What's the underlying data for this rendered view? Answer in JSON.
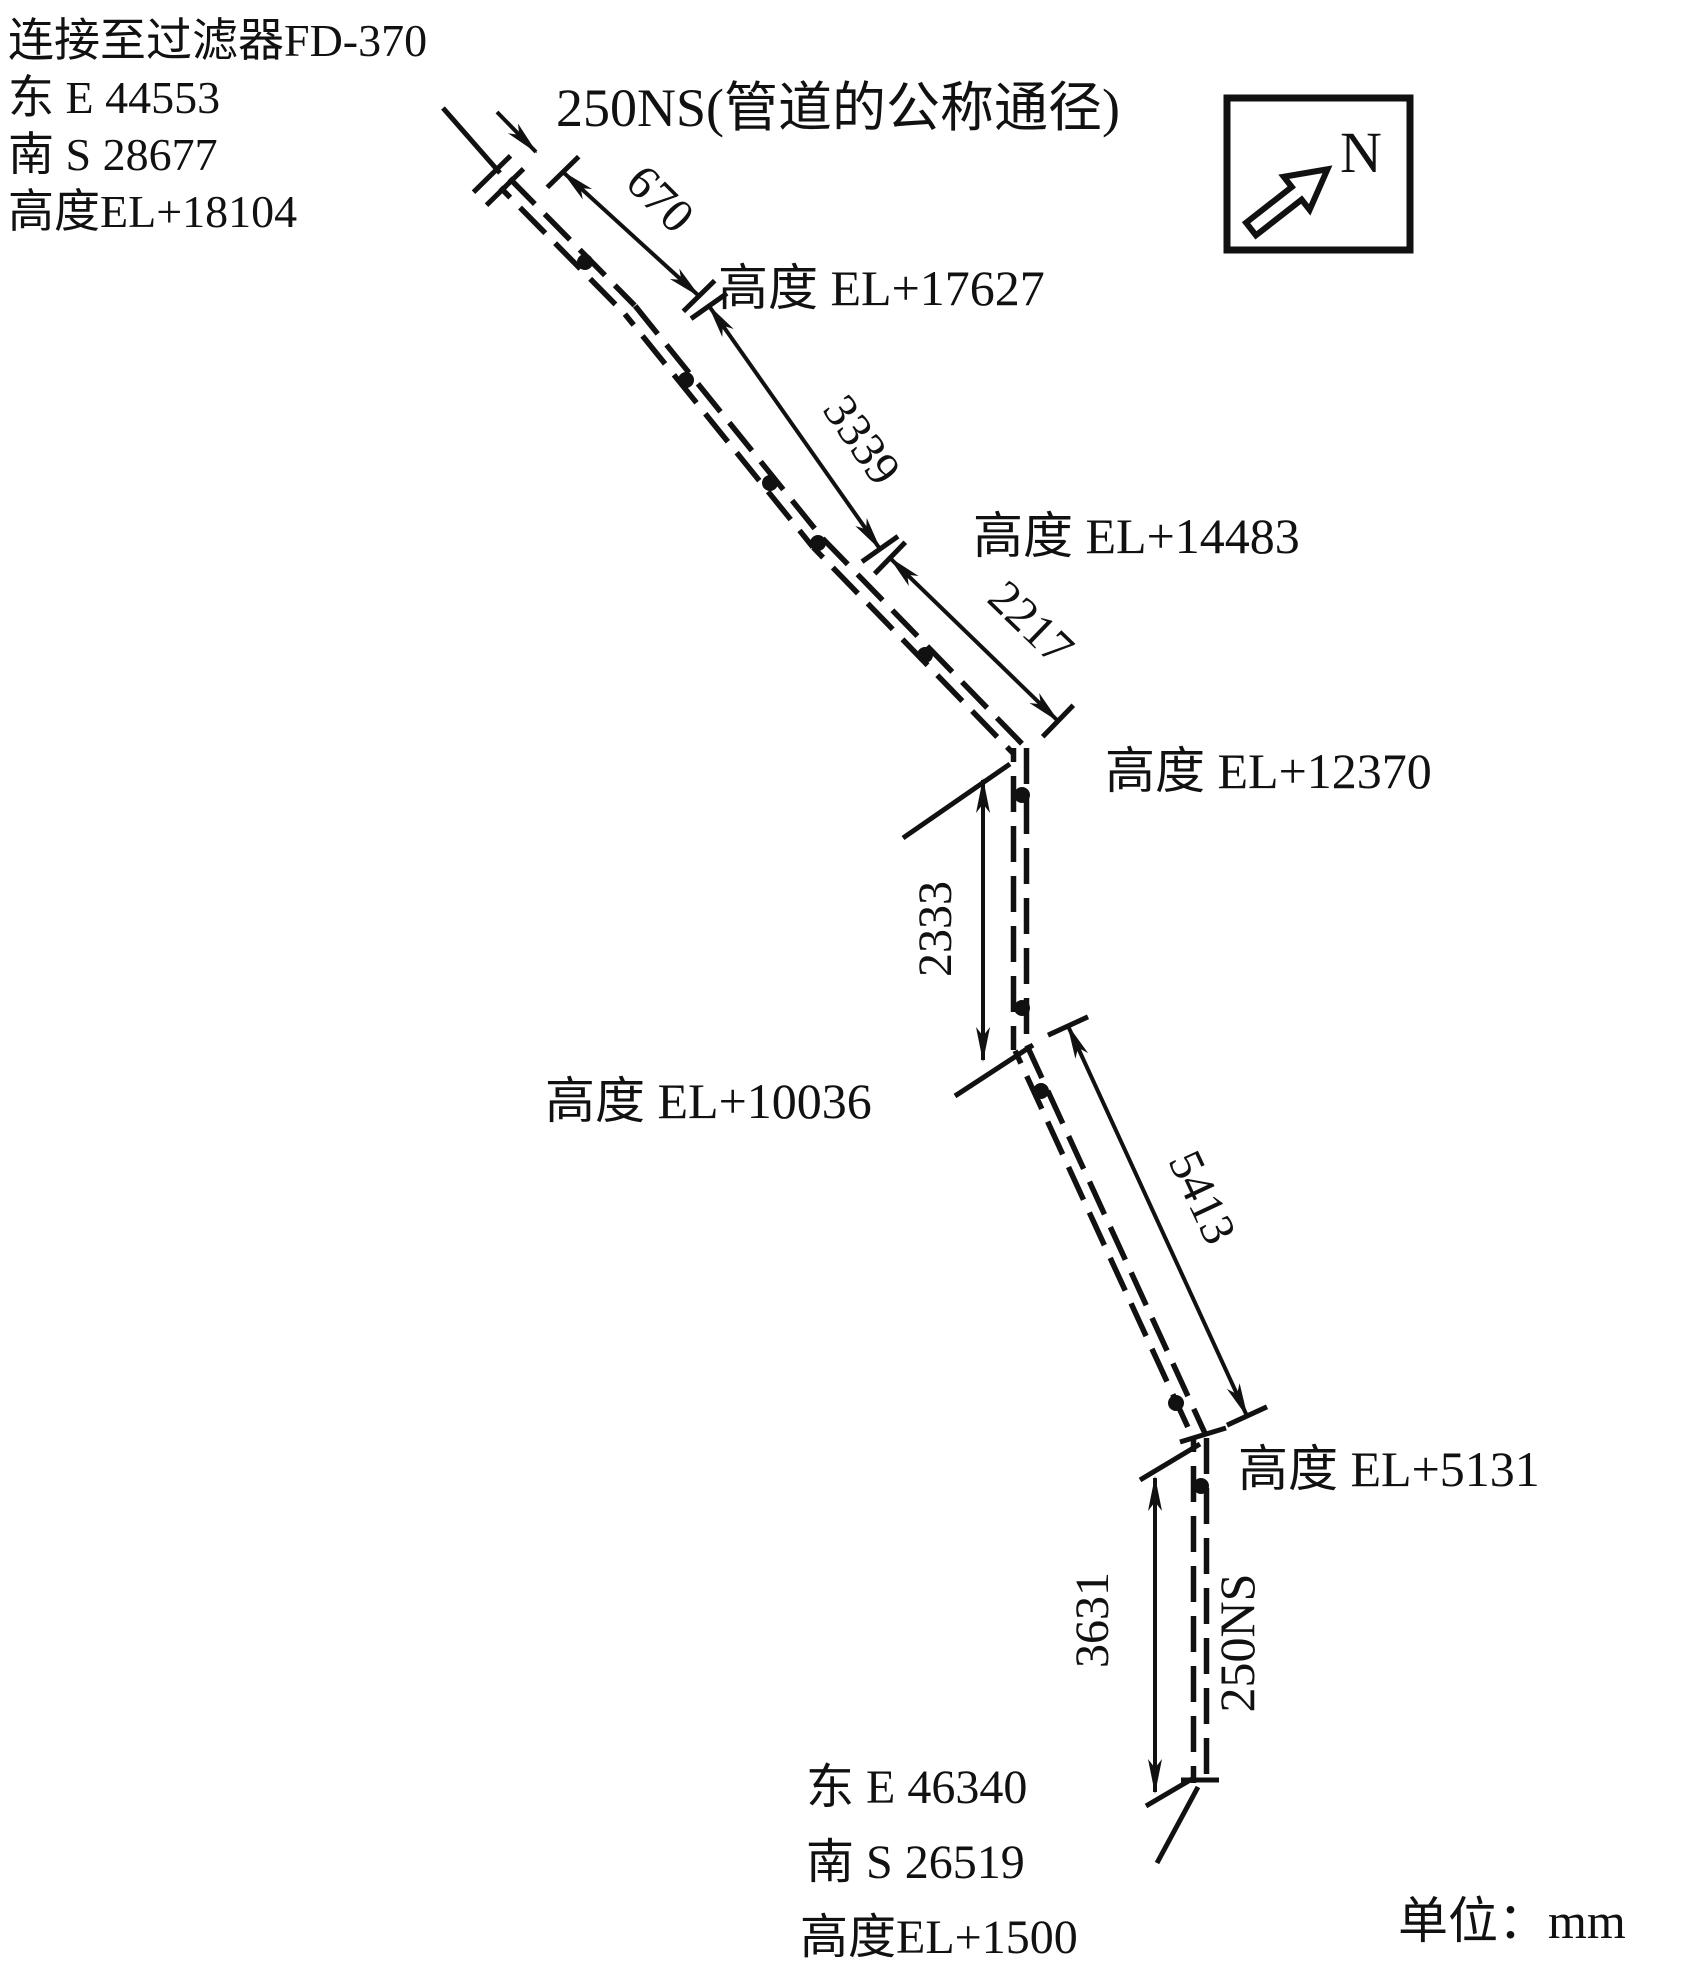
{
  "colors": {
    "ink": "#111111",
    "bg": "#ffffff"
  },
  "source": {
    "connection": "连接至过滤器FD-370",
    "east": "东 E 44553",
    "south": "南 S 28677",
    "elevation": "高度EL+18104"
  },
  "pipe": {
    "spec_label": "250NS(管道的公称通径)",
    "size_tag": "250NS"
  },
  "north": {
    "label": "N"
  },
  "dims": {
    "d670": "670",
    "d3339": "3339",
    "d2217": "2217",
    "d2333": "2333",
    "d5413": "5413",
    "d3631": "3631"
  },
  "elevations": {
    "el17627": "高度 EL+17627",
    "el14483": "高度 EL+14483",
    "el12370": "高度 EL+12370",
    "el10036": "高度 EL+10036",
    "el5131": "高度 EL+5131"
  },
  "destination": {
    "east": "东 E 46340",
    "south": "南 S 26519",
    "elevation": "高度EL+1500"
  },
  "units": {
    "label": "单位：mm"
  }
}
